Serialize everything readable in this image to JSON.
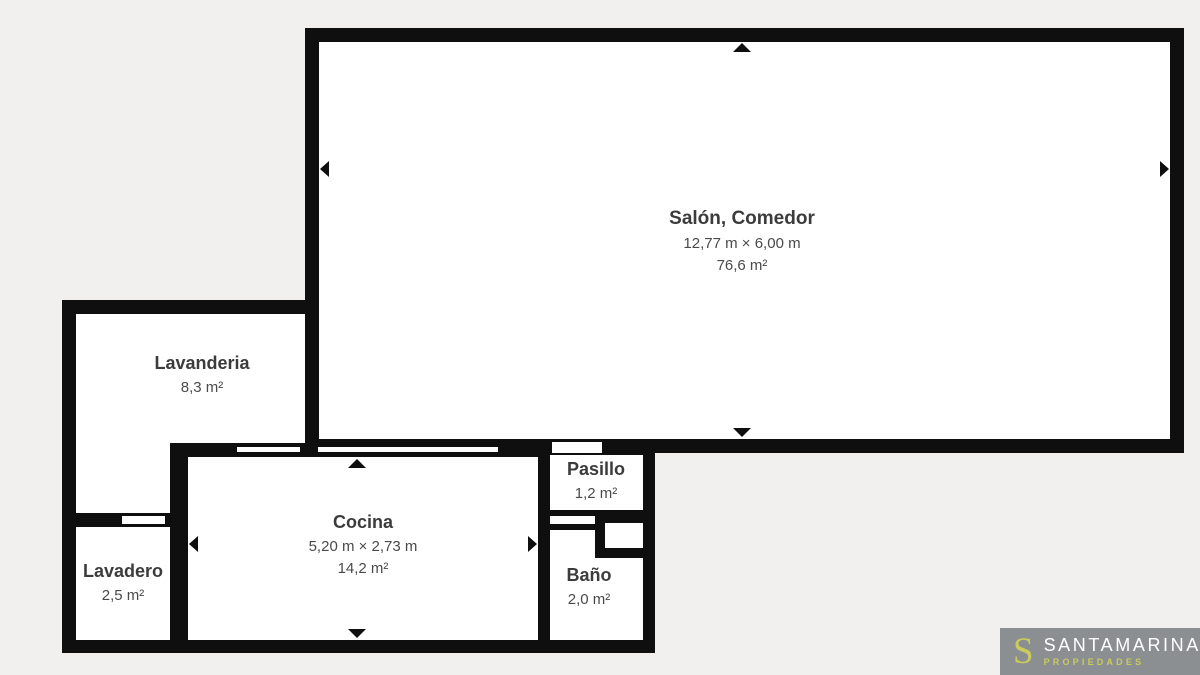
{
  "page": {
    "background_color": "#f1f0ee",
    "wall_color": "#0f0f0f",
    "room_fill_color": "#ffffff",
    "label_color": "#3c3c3c"
  },
  "floorplan": {
    "rooms": {
      "salon": {
        "name": "Salón, Comedor",
        "dimensions": "12,77 m × 6,00 m",
        "area": "76,6 m²"
      },
      "lavanderia": {
        "name": "Lavanderia",
        "area": "8,3 m²"
      },
      "cocina": {
        "name": "Cocina",
        "dimensions": "5,20 m × 2,73 m",
        "area": "14,2 m²"
      },
      "pasillo": {
        "name": "Pasillo",
        "area": "1,2 m²"
      },
      "bano": {
        "name": "Baño",
        "area": "2,0 m²"
      },
      "lavadero": {
        "name": "Lavadero",
        "area": "2,5 m²"
      }
    }
  },
  "branding": {
    "monogram": "S",
    "name": "SANTAMARINA",
    "tagline": "PROPIEDADES",
    "background_color": "#8b8f92",
    "accent_color": "#c9cb5e",
    "name_color": "#ffffff"
  }
}
